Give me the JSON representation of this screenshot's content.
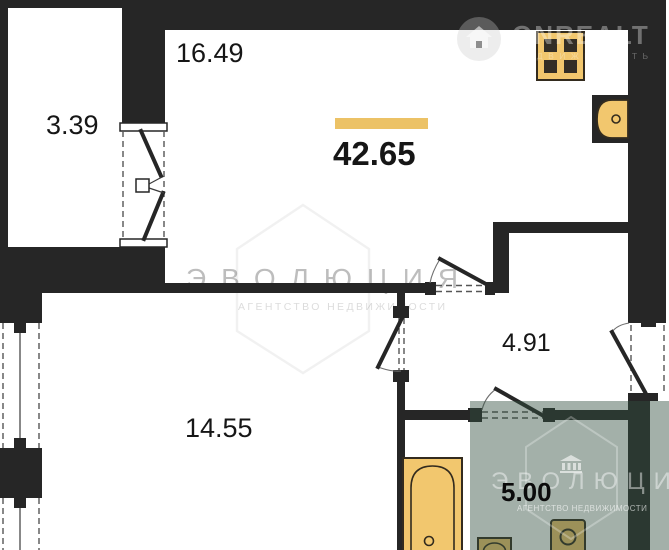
{
  "plan": {
    "total_area": "42.65",
    "rooms": [
      {
        "name": "kitchen-living-room",
        "area": "16.49"
      },
      {
        "name": "balcony",
        "area": "3.39"
      },
      {
        "name": "hallway",
        "area": "4.91"
      },
      {
        "name": "bedroom",
        "area": "14.55"
      },
      {
        "name": "bathroom",
        "area": "5.00"
      }
    ]
  },
  "watermarks": {
    "onrealt": {
      "title": "ONREALT",
      "subtitle": "НЕДВИЖИМОСТЬ"
    },
    "evolution_center": {
      "title": "ЭВОЛЮЦИЯ",
      "subtitle": "АГЕНТСТВО НЕДВИЖИМОСТИ"
    },
    "evolution_badge": {
      "title": "ЭВОЛЮЦИЯ",
      "subtitle": "АГЕНТСТВО НЕДВИЖИМОСТИ"
    }
  },
  "colors": {
    "wall": "#262626",
    "fixture_fill": "#F2C76E",
    "fixture_stroke": "#332b1e",
    "burner": "#332e26",
    "accent_bar": "#ECC266",
    "label": "#161616",
    "badge_overlay": "rgba(50,80,64,0.45)"
  }
}
